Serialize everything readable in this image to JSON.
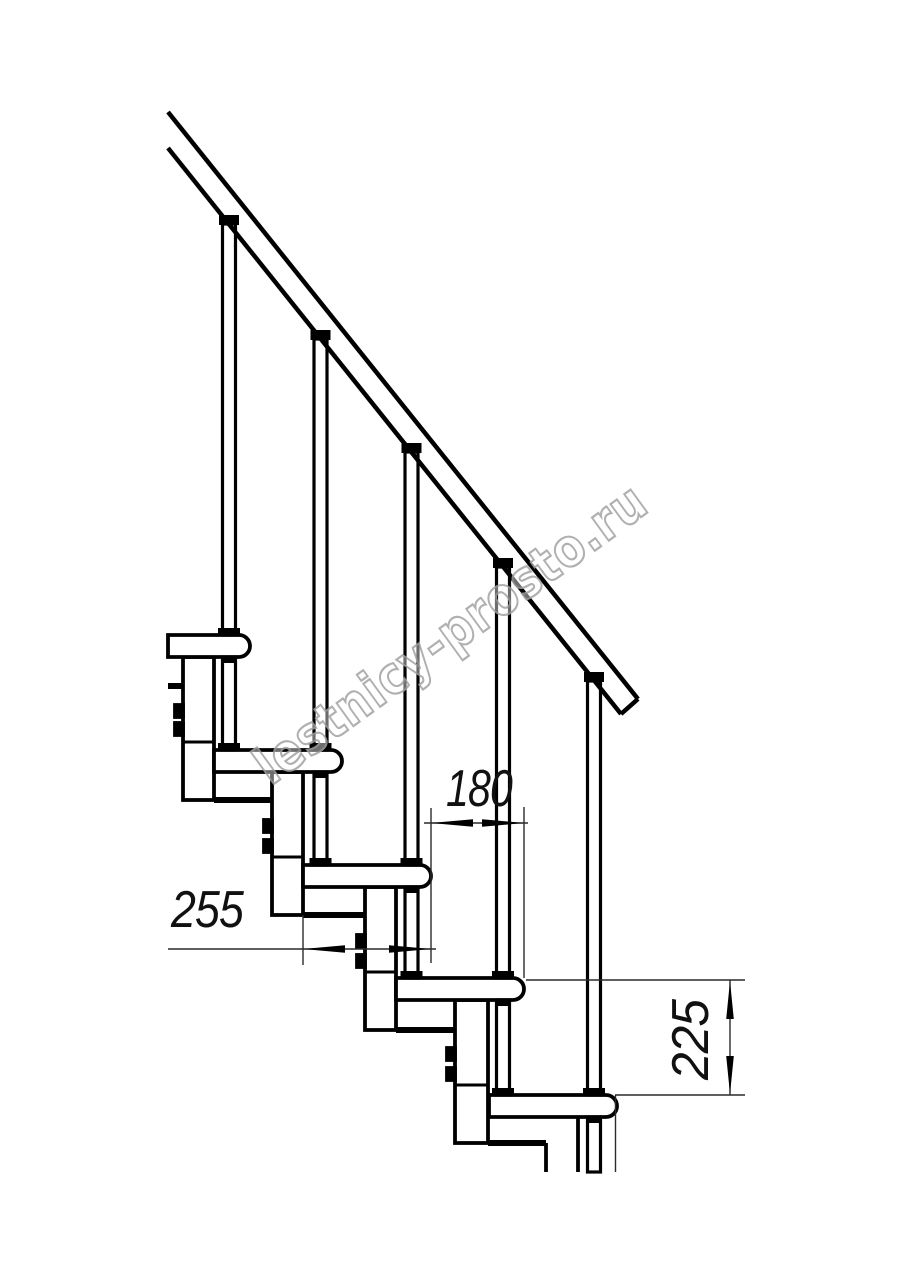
{
  "drawing": {
    "dimensions": {
      "tread_depth": {
        "value": "255"
      },
      "step_run": {
        "value": "180"
      },
      "riser_height": {
        "value": "225"
      }
    },
    "watermark": {
      "text": "lestnicy-prosto.ru"
    },
    "colors": {
      "line": "#000000",
      "thin_line": "#2a2a2a",
      "background": "#ffffff",
      "watermark_outline": "#a3a3a3"
    }
  }
}
